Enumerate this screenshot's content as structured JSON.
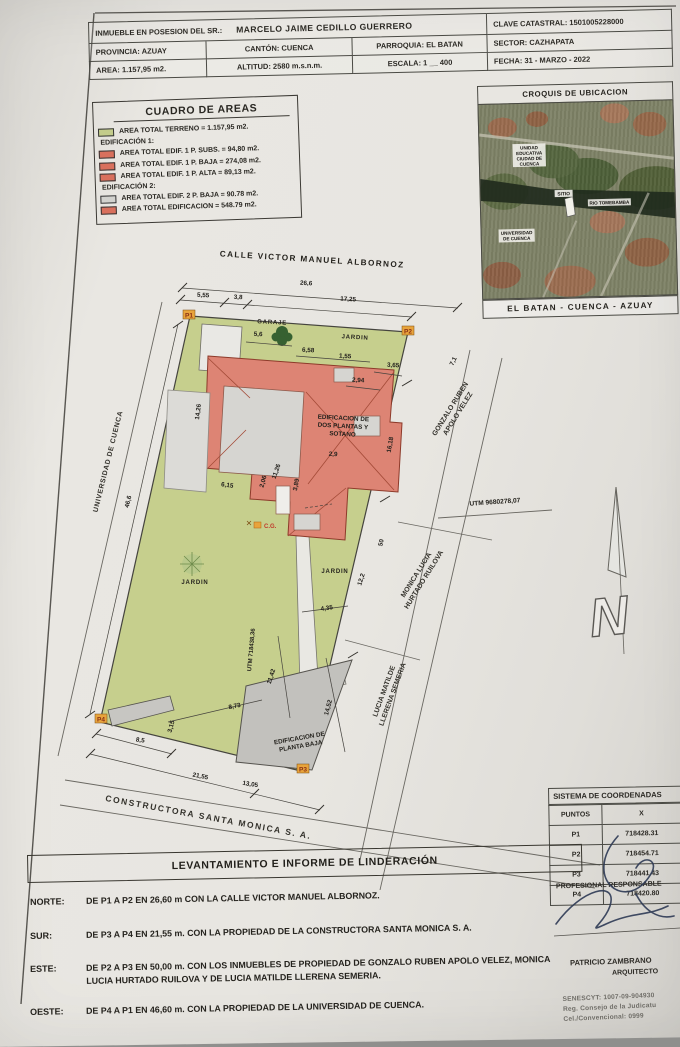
{
  "header": {
    "owner_label": "INMUEBLE EN POSESION DEL SR.:",
    "owner_name": "MARCELO JAIME CEDILLO GUERRERO",
    "clave": "CLAVE CATASTRAL: 1501005228000",
    "provincia": "PROVINCIA: AZUAY",
    "canton": "CANTÓN: CUENCA",
    "parroquia": "PARROQUIA: EL BATAN",
    "sector": "SECTOR: CAZHAPATA",
    "area": "AREA: 1.157,95 m2.",
    "altitud": "ALTITUD: 2580 m.s.n.m.",
    "escala": "ESCALA: 1 __ 400",
    "fecha": "FECHA: 31 - MARZO - 2022"
  },
  "cuadro": {
    "title": "CUADRO DE AREAS",
    "rows": [
      {
        "swatch": "green",
        "text": "AREA TOTAL TERRENO = 1.157,95 m2."
      },
      {
        "swatch": "none",
        "text": "EDIFICACIÓN 1:"
      },
      {
        "swatch": "red",
        "text": "AREA TOTAL EDIF. 1 P.  SUBS. = 94,80 m2."
      },
      {
        "swatch": "red",
        "text": "AREA TOTAL EDIF. 1 P. BAJA = 274,08 m2."
      },
      {
        "swatch": "red",
        "text": "AREA TOTAL EDIF. 1 P.  ALTA = 89,13 m2."
      },
      {
        "swatch": "none",
        "text": "EDIFICACIÓN 2:"
      },
      {
        "swatch": "gray",
        "text": "AREA TOTAL EDIF. 2 P.  BAJA = 90.78 m2."
      },
      {
        "swatch": "red",
        "text": "AREA TOTAL EDIFICACION = 548.79 m2."
      }
    ]
  },
  "croquis": {
    "title": "CROQUIS DE UBICACION",
    "caption": "EL BATAN - CUENCA - AZUAY",
    "labels": {
      "unidad_l1": "UNIDAD",
      "unidad_l2": "EDUCATIVA",
      "unidad_l3": "CIUDAD DE",
      "unidad_l4": "CUENCA",
      "sitio": "SITIO",
      "rio": "RIO TOMEBAMBA",
      "uni_l1": "UNIVERSIDAD",
      "uni_l2": "DE CUENCA"
    }
  },
  "plan": {
    "street_top": "CALLE VICTOR MANUEL ALBORNOZ",
    "north_letter": "N",
    "labels": {
      "garaje": "GARAJE",
      "jardin1": "JARDIN",
      "jardin2": "JARDIN",
      "jardin3": "JARDIN",
      "edif1_l1": "EDIFICACION DE",
      "edif1_l2": "DOS PLANTAS Y",
      "edif1_l3": "SOTANO",
      "edif2_l1": "EDIFICACION DE",
      "edif2_l2": "PLANTA BAJA",
      "cg": "C.G.",
      "utm_vertical": "UTM 718438,36",
      "utm_horizontal": "UTM 9680278,07",
      "universidad": "UNIVERSIDAD DE CUENCA",
      "gonzalo_l1": "GONZALO RUBEN",
      "gonzalo_l2": "APOLO VELEZ",
      "monica_l1": "MONICA LUCIA",
      "monica_l2": "HURTADO RUILOVA",
      "lucia_l1": "LUCIA MATILDE",
      "lucia_l2": "LLERENA SEMERIA",
      "constructora": "CONSTRUCTORA SANTA MONICA S. A.",
      "p1": "P1",
      "p2": "P2",
      "p3": "P3",
      "p4": "P4"
    },
    "dims": {
      "total": "26,6",
      "seg1": "5,55",
      "seg2": "3,8",
      "seg3": "17,25",
      "right1": "7,1",
      "right2": "16,18",
      "right3": "50",
      "right4": "12,2",
      "right5": "14,52",
      "left1": "46,6",
      "left2": "14,26",
      "bottom1": "8,5",
      "bottom2": "3,15",
      "bottom3": "21,55",
      "bottom4": "13,05",
      "bottom5": "8,73",
      "bottom6": "11,42",
      "bottom7": "4,35",
      "g1": "5,6",
      "g2": "6,58",
      "g3": "1,55",
      "g4": "3,65",
      "g5": "2,94",
      "i1": "2,9",
      "i2": "11,26",
      "i3": "2,06",
      "i4": "6,15",
      "i5": "3,89"
    }
  },
  "coords": {
    "title": "SISTEMA DE COORDENADAS",
    "col_puntos": "PUNTOS",
    "col_x": "X",
    "rows": [
      {
        "p": "P1",
        "x": "718428.31"
      },
      {
        "p": "P2",
        "x": "718454.71"
      },
      {
        "p": "P3",
        "x": "718441.43"
      },
      {
        "p": "P4",
        "x": "718420.80"
      }
    ]
  },
  "firma": {
    "responsable": "PROFESIONAL RESPONSABLE",
    "nombre": "PATRICIO ZAMBRANO",
    "titulo": "ARQUITECTO",
    "linea1": "SENESCYT: 1007-09-904930",
    "linea2": "Reg. Consejo de la Judicatu",
    "linea3": "Cel./Convencional: 0999"
  },
  "banner": {
    "title": "LEVANTAMIENTO E INFORME DE LINDERACIÓN"
  },
  "linderos": {
    "rows": [
      {
        "label": "NORTE:",
        "text": "DE P1 A P2 EN 26,60 m  CON LA CALLE VICTOR MANUEL ALBORNOZ."
      },
      {
        "label": "SUR:",
        "text": "DE P3 A P4 EN 21,55 m. CON LA PROPIEDAD DE LA CONSTRUCTORA SANTA MONICA S. A."
      },
      {
        "label": "ESTE:",
        "text": "DE P2 A P3 EN 50,00 m. CON LOS INMUEBLES DE PROPIEDAD DE GONZALO RUBEN APOLO VELEZ, MONICA LUCIA HURTADO RUILOVA Y DE LUCIA MATILDE LLERENA SEMERIA."
      },
      {
        "label": "OESTE:",
        "text": "DE P4 A P1 EN 46,60 m. CON LA PROPIEDAD DE LA UNIVERSIDAD DE CUENCA."
      }
    ]
  },
  "colors": {
    "terreno_green": "#c3cc8b",
    "edificacion_red": "#d9705d",
    "edificacion_gray": "#d2d2ce",
    "marker_orange": "#e8a43c",
    "paper": "#e8e6e1"
  }
}
